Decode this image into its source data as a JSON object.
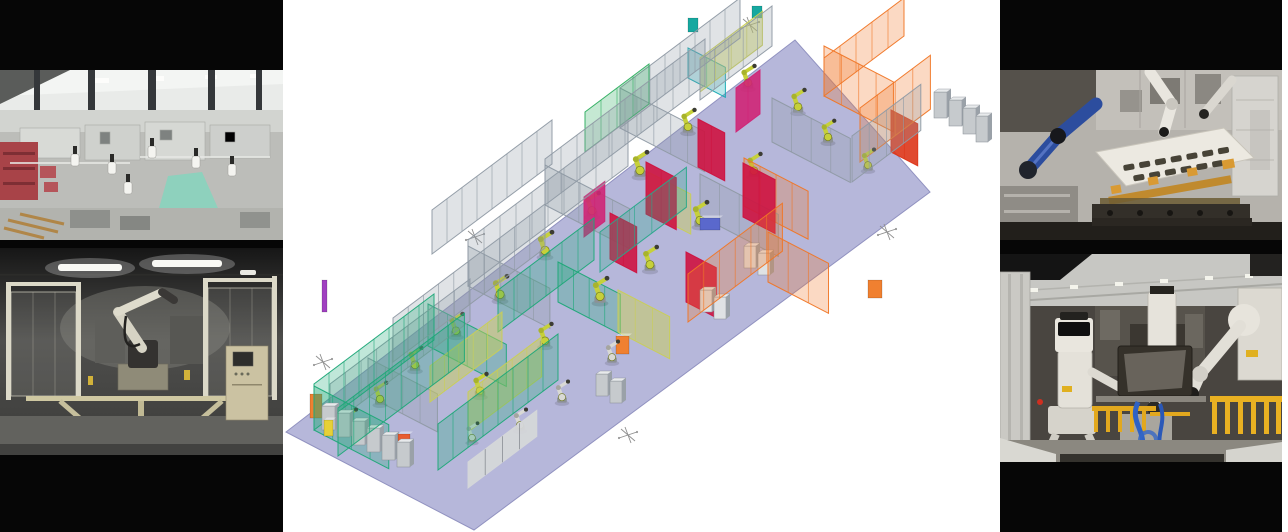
{
  "palette": {
    "background": "#ffffff",
    "letterbox_black": "#060606",
    "floor_lavender": "#b6b7da",
    "floor_edge": "#9192c0",
    "fence_gray": "#8f9aa4",
    "fence_green": "#1ea878",
    "fence_teal": "#12a8b2",
    "fence_orange": "#f07626",
    "panel_red": "#ce1340",
    "panel_magenta": "#cf2576",
    "panel_khaki": "#c9cf55",
    "robot_yellow_green": "#c6d03a",
    "robot_white": "#d9d9d5",
    "photo_teal_path": "#8ed1bd",
    "photo_red_rack": "#a84348",
    "photo_blue_robot": "#2c4d9e",
    "photo_gold_jig": "#c08a2e",
    "photo_yellow_rail": "#e2a81e",
    "photo_hose_blue": "#2f62c4"
  },
  "cad_scene": {
    "robot_color": "#c6d03a",
    "floor": {
      "points": "286,432 795,40 930,192 474,530",
      "fill": "#b6b7da",
      "edge": "#9192c0"
    },
    "fences": [
      {
        "x": 620,
        "y": 128,
        "a": "u",
        "l": 150,
        "h": 40,
        "c": "#8f9aa4"
      },
      {
        "x": 545,
        "y": 205,
        "a": "u",
        "l": 200,
        "h": 46,
        "c": "#8f9aa4"
      },
      {
        "x": 468,
        "y": 286,
        "a": "u",
        "l": 200,
        "h": 46,
        "c": "#8f9aa4"
      },
      {
        "x": 393,
        "y": 362,
        "a": "u",
        "l": 190,
        "h": 44,
        "c": "#8f9aa4"
      },
      {
        "x": 330,
        "y": 426,
        "a": "u",
        "l": 175,
        "h": 42,
        "c": "#8f9aa4"
      },
      {
        "x": 620,
        "y": 128,
        "a": "v",
        "l": 95,
        "h": 40,
        "c": "#8f9aa4"
      },
      {
        "x": 545,
        "y": 205,
        "a": "v",
        "l": 95,
        "h": 40,
        "c": "#8f9aa4"
      },
      {
        "x": 468,
        "y": 286,
        "a": "v",
        "l": 92,
        "h": 40,
        "c": "#8f9aa4"
      },
      {
        "x": 772,
        "y": 142,
        "a": "v",
        "l": 88,
        "h": 44,
        "c": "#8f9aa4"
      },
      {
        "x": 700,
        "y": 216,
        "a": "v",
        "l": 88,
        "h": 42,
        "c": "#8f9aa4"
      },
      {
        "x": 852,
        "y": 182,
        "a": "u",
        "l": 86,
        "h": 46,
        "c": "#8f9aa4"
      },
      {
        "x": 368,
        "y": 396,
        "a": "v",
        "l": 78,
        "h": 38,
        "c": "#8f9aa4"
      },
      {
        "x": 700,
        "y": 100,
        "a": "u",
        "l": 90,
        "h": 40,
        "c": "#8f9aa4"
      },
      {
        "x": 432,
        "y": 254,
        "a": "u",
        "l": 150,
        "h": 44,
        "c": "#8f9aa4"
      },
      {
        "x": 314,
        "y": 430,
        "a": "u",
        "l": 150,
        "h": 46,
        "c": "#1ea878"
      },
      {
        "x": 338,
        "y": 456,
        "a": "u",
        "l": 158,
        "h": 48,
        "c": "#1ea878"
      },
      {
        "x": 314,
        "y": 430,
        "a": "v",
        "l": 84,
        "h": 44,
        "c": "#1ea878"
      },
      {
        "x": 428,
        "y": 346,
        "a": "v",
        "l": 88,
        "h": 42,
        "c": "#1ea878"
      },
      {
        "x": 438,
        "y": 470,
        "a": "u",
        "l": 150,
        "h": 46,
        "c": "#1ea878"
      },
      {
        "x": 498,
        "y": 332,
        "a": "u",
        "l": 120,
        "h": 42,
        "c": "#1ea878"
      },
      {
        "x": 558,
        "y": 302,
        "a": "v",
        "l": 70,
        "h": 40,
        "c": "#1ea878"
      },
      {
        "x": 585,
        "y": 152,
        "a": "u",
        "l": 80,
        "h": 40,
        "c": "#2fae60"
      },
      {
        "x": 600,
        "y": 272,
        "a": "u",
        "l": 108,
        "h": 40,
        "c": "#28a88a"
      },
      {
        "x": 688,
        "y": 78,
        "a": "v",
        "l": 42,
        "h": 30,
        "c": "#12a8b2"
      },
      {
        "x": 430,
        "y": 402,
        "a": "u",
        "l": 90,
        "h": 36,
        "c": "#c9cf55",
        "s": true,
        "o": 0.5
      },
      {
        "x": 468,
        "y": 432,
        "a": "u",
        "l": 92,
        "h": 40,
        "c": "#c9cf55",
        "s": true,
        "o": 0.5
      },
      {
        "x": 618,
        "y": 332,
        "a": "v",
        "l": 58,
        "h": 42,
        "c": "#c9cf55",
        "s": true,
        "o": 0.5
      },
      {
        "x": 648,
        "y": 212,
        "a": "v",
        "l": 48,
        "h": 40,
        "c": "#c9cf55",
        "s": true,
        "o": 0.45
      },
      {
        "x": 700,
        "y": 92,
        "a": "u",
        "l": 78,
        "h": 34,
        "c": "#c9cf55",
        "s": true,
        "o": 0.45
      },
      {
        "x": 824,
        "y": 96,
        "a": "u",
        "l": 100,
        "h": 38,
        "c": "#f07626"
      },
      {
        "x": 860,
        "y": 162,
        "a": "u",
        "l": 88,
        "h": 54,
        "c": "#f07626"
      },
      {
        "x": 824,
        "y": 96,
        "a": "v",
        "l": 78,
        "h": 50,
        "c": "#f07626"
      },
      {
        "x": 768,
        "y": 282,
        "a": "v",
        "l": 68,
        "h": 50,
        "c": "#f07626"
      },
      {
        "x": 744,
        "y": 206,
        "a": "v",
        "l": 72,
        "h": 48,
        "c": "#f07626"
      },
      {
        "x": 688,
        "y": 322,
        "a": "u",
        "l": 118,
        "h": 48,
        "c": "#f07626"
      },
      {
        "x": 646,
        "y": 214,
        "a": "v",
        "l": 34,
        "h": 52,
        "c": "#ce1340",
        "s": true
      },
      {
        "x": 698,
        "y": 167,
        "a": "v",
        "l": 30,
        "h": 48,
        "c": "#ce1340",
        "s": true
      },
      {
        "x": 743,
        "y": 217,
        "a": "v",
        "l": 36,
        "h": 54,
        "c": "#ce1340",
        "s": true
      },
      {
        "x": 610,
        "y": 259,
        "a": "v",
        "l": 30,
        "h": 46,
        "c": "#ce1340",
        "s": true
      },
      {
        "x": 686,
        "y": 302,
        "a": "v",
        "l": 34,
        "h": 50,
        "c": "#ce1340",
        "s": true
      },
      {
        "x": 891,
        "y": 152,
        "a": "v",
        "l": 30,
        "h": 42,
        "c": "#dd3518",
        "s": true
      },
      {
        "x": 736,
        "y": 132,
        "a": "u",
        "l": 30,
        "h": 44,
        "c": "#cf2576",
        "s": true
      },
      {
        "x": 584,
        "y": 237,
        "a": "u",
        "l": 26,
        "h": 40,
        "c": "#cf2576",
        "s": true
      },
      {
        "x": 468,
        "y": 488,
        "a": "u",
        "l": 86,
        "h": 26,
        "c": "#d5d7d9",
        "s": true,
        "o": 0.95,
        "pc": "#70767c"
      }
    ],
    "cabinets": [
      {
        "x": 322,
        "y": 430,
        "w": 13,
        "h": 24
      },
      {
        "x": 337,
        "y": 437,
        "w": 13,
        "h": 24
      },
      {
        "x": 352,
        "y": 445,
        "w": 13,
        "h": 24
      },
      {
        "x": 367,
        "y": 452,
        "w": 13,
        "h": 24
      },
      {
        "x": 382,
        "y": 460,
        "w": 13,
        "h": 25
      },
      {
        "x": 397,
        "y": 467,
        "w": 13,
        "h": 25
      },
      {
        "x": 934,
        "y": 118,
        "w": 13,
        "h": 26
      },
      {
        "x": 949,
        "y": 126,
        "w": 13,
        "h": 26
      },
      {
        "x": 963,
        "y": 134,
        "w": 13,
        "h": 26
      },
      {
        "x": 976,
        "y": 142,
        "w": 12,
        "h": 26
      },
      {
        "x": 744,
        "y": 268,
        "w": 12,
        "h": 22,
        "c": "#dfe2e4"
      },
      {
        "x": 758,
        "y": 275,
        "w": 12,
        "h": 22,
        "c": "#dfe2e4"
      },
      {
        "x": 700,
        "y": 312,
        "w": 12,
        "h": 22,
        "c": "#dfe2e4"
      },
      {
        "x": 714,
        "y": 319,
        "w": 12,
        "h": 22,
        "c": "#dfe2e4"
      },
      {
        "x": 596,
        "y": 396,
        "w": 12,
        "h": 22
      },
      {
        "x": 610,
        "y": 403,
        "w": 12,
        "h": 22
      }
    ],
    "robots": [
      {
        "x": 748,
        "y": 88,
        "k": 1.3
      },
      {
        "x": 798,
        "y": 112,
        "k": 1.3
      },
      {
        "x": 688,
        "y": 132,
        "k": 1.3
      },
      {
        "x": 640,
        "y": 176,
        "k": 1.4
      },
      {
        "x": 592,
        "y": 216,
        "k": 1.35
      },
      {
        "x": 700,
        "y": 226,
        "k": 1.4
      },
      {
        "x": 754,
        "y": 176,
        "k": 1.3
      },
      {
        "x": 545,
        "y": 256,
        "k": 1.4
      },
      {
        "x": 500,
        "y": 300,
        "k": 1.4
      },
      {
        "x": 456,
        "y": 336,
        "k": 1.3
      },
      {
        "x": 415,
        "y": 370,
        "k": 1.3
      },
      {
        "x": 380,
        "y": 404,
        "k": 1.25
      },
      {
        "x": 350,
        "y": 430,
        "k": 1.2
      },
      {
        "x": 600,
        "y": 302,
        "k": 1.4
      },
      {
        "x": 650,
        "y": 270,
        "k": 1.35
      },
      {
        "x": 545,
        "y": 346,
        "k": 1.3
      },
      {
        "x": 480,
        "y": 396,
        "k": 1.3
      },
      {
        "x": 828,
        "y": 142,
        "k": 1.25
      },
      {
        "x": 868,
        "y": 170,
        "k": 1.2
      },
      {
        "x": 520,
        "y": 430,
        "k": 1.2,
        "c": "#d9d9d5"
      },
      {
        "x": 562,
        "y": 402,
        "k": 1.2,
        "c": "#d9d9d5"
      },
      {
        "x": 472,
        "y": 442,
        "k": 1.1,
        "c": "#d9d9d5"
      },
      {
        "x": 612,
        "y": 362,
        "k": 1.2,
        "c": "#d9d9d5"
      }
    ],
    "parts": [
      {
        "x": 310,
        "y": 418,
        "w": 12,
        "h": 24,
        "c": "#f08030"
      },
      {
        "x": 324,
        "y": 436,
        "w": 9,
        "h": 16,
        "c": "#e6d037"
      },
      {
        "x": 398,
        "y": 462,
        "w": 12,
        "h": 28,
        "c": "#e85c30"
      },
      {
        "x": 616,
        "y": 354,
        "w": 13,
        "h": 18,
        "c": "#f08030"
      },
      {
        "x": 868,
        "y": 298,
        "w": 14,
        "h": 18,
        "c": "#f08030"
      },
      {
        "x": 700,
        "y": 230,
        "w": 20,
        "h": 12,
        "c": "#5a68cc"
      },
      {
        "x": 322,
        "y": 312,
        "w": 5,
        "h": 32,
        "c": "#a040c0"
      },
      {
        "x": 688,
        "y": 32,
        "w": 10,
        "h": 14,
        "c": "#16a8a0"
      },
      {
        "x": 752,
        "y": 18,
        "w": 10,
        "h": 12,
        "c": "#16a8a0"
      }
    ],
    "stars": [
      {
        "x": 750,
        "y": 25
      },
      {
        "x": 475,
        "y": 237
      },
      {
        "x": 323,
        "y": 362
      },
      {
        "x": 628,
        "y": 435
      },
      {
        "x": 887,
        "y": 232
      }
    ]
  }
}
